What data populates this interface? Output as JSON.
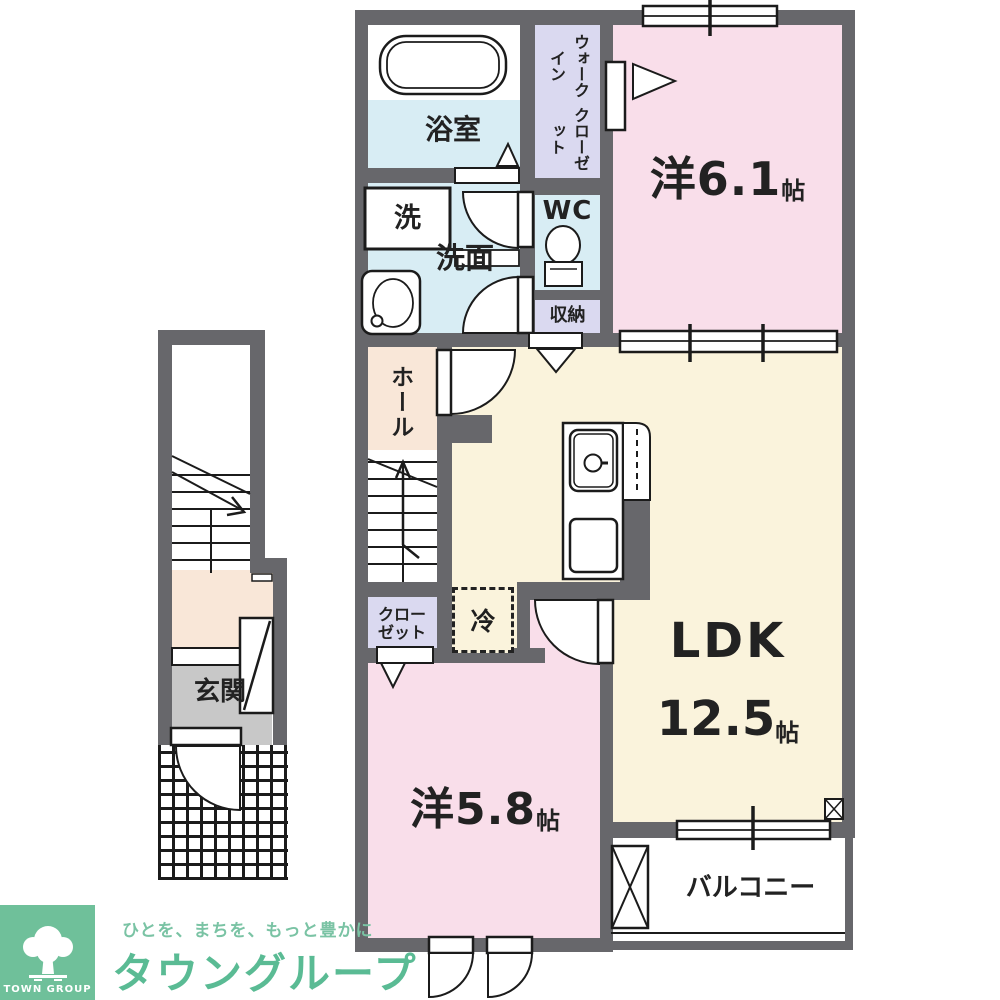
{
  "rooms": {
    "bathroom": "浴室",
    "washer": "洗",
    "washroom": "洗面",
    "wc": "WC",
    "walk_in_closet": [
      "ウォークイン",
      "クローゼット"
    ],
    "storage": "収納",
    "western_room_1": {
      "name": "洋6.1",
      "unit": "帖"
    },
    "hall": "ホール",
    "closet": [
      "クロー",
      "ゼット"
    ],
    "fridge": "冷",
    "ldk": {
      "name": "LDK",
      "size": "12.5",
      "unit": "帖"
    },
    "western_room_2": {
      "name": "洋5.8",
      "unit": "帖"
    },
    "balcony": "バルコニー",
    "entrance": "玄関"
  },
  "logo": {
    "brand_en": "TOWN GROUP",
    "tagline": "ひとを、まちを、もっと豊かに",
    "brand_jp": "タウングループ"
  },
  "colors": {
    "wall": "#67676B",
    "room_pink": "#F9DEEA",
    "room_cream": "#FAF3DC",
    "room_blue": "#D8EDF4",
    "room_lavender": "#DAD9F0",
    "room_peach": "#F9E7D8",
    "entrance_gray": "#C8C8C8",
    "logo_green": "#6FC09A",
    "brand_text_green": "#5ABB94"
  }
}
